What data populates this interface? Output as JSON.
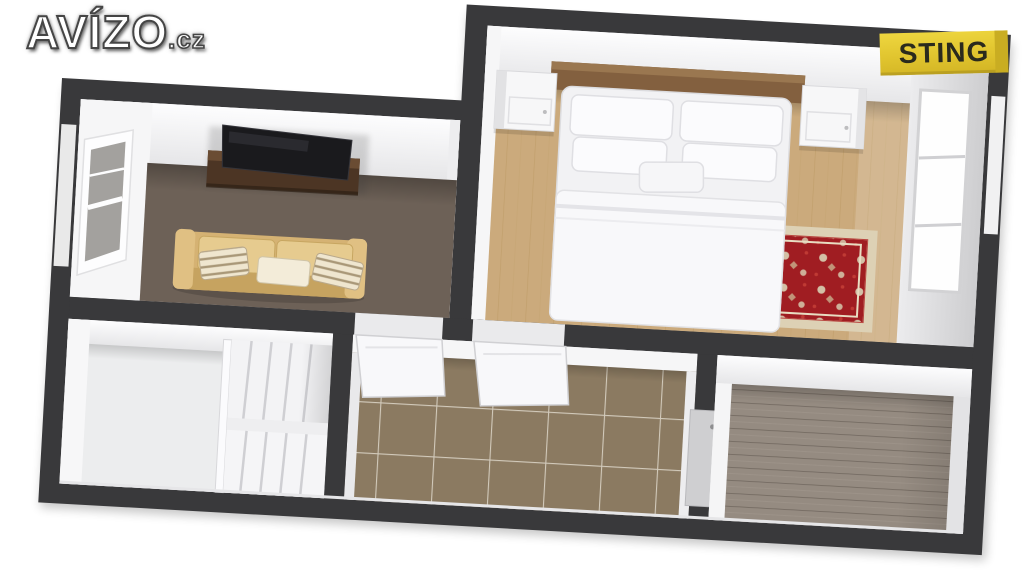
{
  "logo": {
    "brand": "AVÍZO",
    "tld": ".cz"
  },
  "badge": {
    "label": "STING",
    "background": "#e3c52f",
    "text_color": "#2a2a1d"
  },
  "scene": {
    "type": "3d-floor-plan-render",
    "rooms": [
      "living-room",
      "bedroom",
      "staircase-hall",
      "corridor",
      "back-room"
    ],
    "colors": {
      "background": "#ffffff",
      "outer_wall": "#39393b",
      "inner_wall_face": "#f2f2f3",
      "living_room_carpet": "#6d6157",
      "bedroom_floor_oak": "#cbaa7c",
      "corridor_tiles": "#8b7a61",
      "plank_floor": "#958b81",
      "staircase_floor": "#ecedee",
      "rug_field": "#a01d22",
      "rug_border": "#ddd1b5",
      "sofa": "#d5b273",
      "tv_shelf": "#4c3524",
      "tv_screen": "#1a1a1d",
      "bed_linen": "#f4f4f5",
      "headboard": "#83603f"
    }
  }
}
